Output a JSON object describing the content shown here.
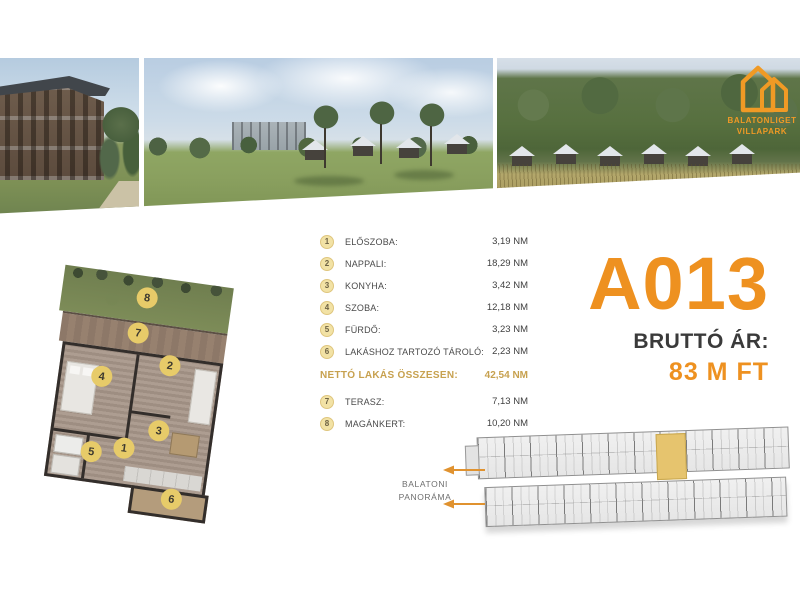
{
  "logo": {
    "line1": "BALATONLIGET",
    "line2": "VILLAPARK"
  },
  "unit": {
    "id": "A013",
    "price_label": "BRUTTÓ ÁR:",
    "price_value": "83 M FT"
  },
  "rooms": [
    {
      "num": "1",
      "label": "ELŐSZOBA:",
      "value": "3,19 NM"
    },
    {
      "num": "2",
      "label": "NAPPALI:",
      "value": "18,29 NM"
    },
    {
      "num": "3",
      "label": "KONYHA:",
      "value": "3,42 NM"
    },
    {
      "num": "4",
      "label": "SZOBA:",
      "value": "12,18 NM"
    },
    {
      "num": "5",
      "label": "FÜRDŐ:",
      "value": "3,23 NM"
    },
    {
      "num": "6",
      "label": "LAKÁSHOZ TARTOZÓ TÁROLÓ:",
      "value": "2,23 NM"
    }
  ],
  "total": {
    "label": "NETTÓ LAKÁS ÖSSZESEN:",
    "value": "42,54 NM"
  },
  "outdoor": [
    {
      "num": "7",
      "label": "TERASZ:",
      "value": "7,13 NM"
    },
    {
      "num": "8",
      "label": "MAGÁNKERT:",
      "value": "10,20 NM"
    }
  ],
  "floorplan": {
    "markers": [
      "1",
      "2",
      "3",
      "4",
      "5",
      "6",
      "7",
      "8"
    ]
  },
  "siteplan": {
    "panorama_line1": "BALATONI",
    "panorama_line2": "PANORÁMA"
  },
  "colors": {
    "accent_orange": "#EE9120",
    "gold_text": "#C7A14F",
    "badge_fill": "#F2E2A5",
    "plan_marker_fill": "#E7CB69",
    "highlighted_unit": "#E6C46E",
    "price_dark": "#3A3A3A"
  }
}
